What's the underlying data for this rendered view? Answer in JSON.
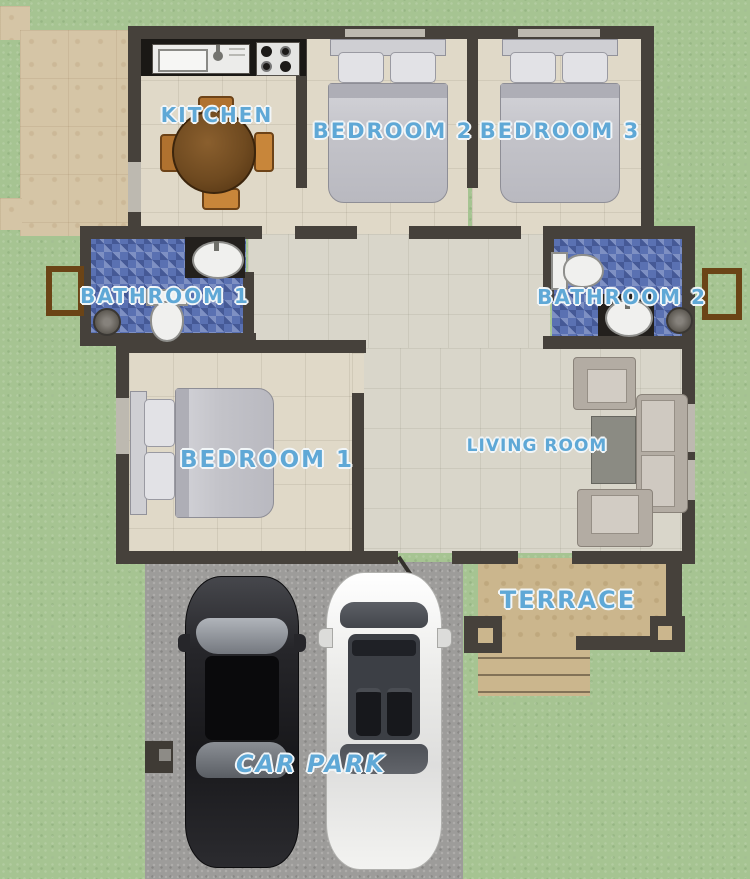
{
  "rooms": {
    "kitchen": {
      "label": "KITCHEN"
    },
    "bedroom2": {
      "label": "BEDROOM 2"
    },
    "bedroom3": {
      "label": "BEDROOM 3"
    },
    "bathroom1": {
      "label": "BATHROOM 1"
    },
    "bathroom2": {
      "label": "BATHROOM 2"
    },
    "bedroom1": {
      "label": "BEDROOM 1"
    },
    "living_room": {
      "label": "LIVING ROOM"
    },
    "terrace": {
      "label": "TERRACE"
    },
    "car_park": {
      "label": "CAR PARK"
    }
  },
  "colors": {
    "grass": "#a6c492",
    "wall": "#46413b",
    "patio_tan": "#d5c5a6",
    "room_floor": "#e0d9c8",
    "hall_floor": "#d9d6ca",
    "bathroom_tile": "#5a71b2",
    "terrace": "#cbb68d",
    "driveway": "#9d9c9a",
    "kitchen_counter": "#1a1815",
    "table_wood": "#7a5224",
    "chair_wood": "#b0722f",
    "label_text": "#5fa8d6",
    "black_car": "#222226",
    "white_car": "#f0f0ee",
    "window_frame_brown": "#6b4416"
  }
}
